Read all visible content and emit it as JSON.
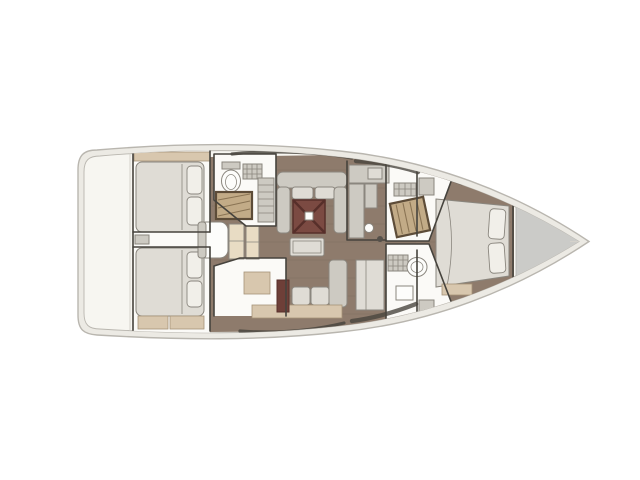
{
  "scene": {
    "subject": "sailing-yacht-interior-floor-plan",
    "view": "top-down",
    "bow_direction": "right",
    "text_visible": false
  },
  "regions": [
    {
      "name": "aft-cabin-port"
    },
    {
      "name": "aft-cabin-starboard"
    },
    {
      "name": "aft-head-port"
    },
    {
      "name": "companionway"
    },
    {
      "name": "salon"
    },
    {
      "name": "galley"
    },
    {
      "name": "forward-shower-port"
    },
    {
      "name": "forward-head-starboard"
    },
    {
      "name": "forward-cabin"
    },
    {
      "name": "foredeck"
    }
  ],
  "colors": {
    "background": "#ffffff",
    "hull_fill": "#eceae4",
    "deck_fill": "#f7f6f1",
    "hull_outline": "#b9b6af",
    "wall": "#46433d",
    "wood_floor": "#8e7b6c",
    "wood_plank": "#6f5e50",
    "room_floor": "#fbfaf7",
    "furniture": "#cdcac2",
    "furniture_light": "#dfdcd5",
    "cushion": "#f1efe9",
    "trim_wood": "#d8c7ae",
    "step_wood": "#e8dcc4",
    "table_red": "#7b4a42",
    "table_red_dark": "#572f2a",
    "red_cabinet": "#6e3f38",
    "grate_fill": "#c2ab87",
    "grate_line": "#8a7454",
    "grate_frame": "#5d4c38",
    "foredeck": "#cbcbc8",
    "window_band": "#4a463f",
    "fixture_white": "#fdfdfb",
    "fixture_line": "#8a867e"
  }
}
